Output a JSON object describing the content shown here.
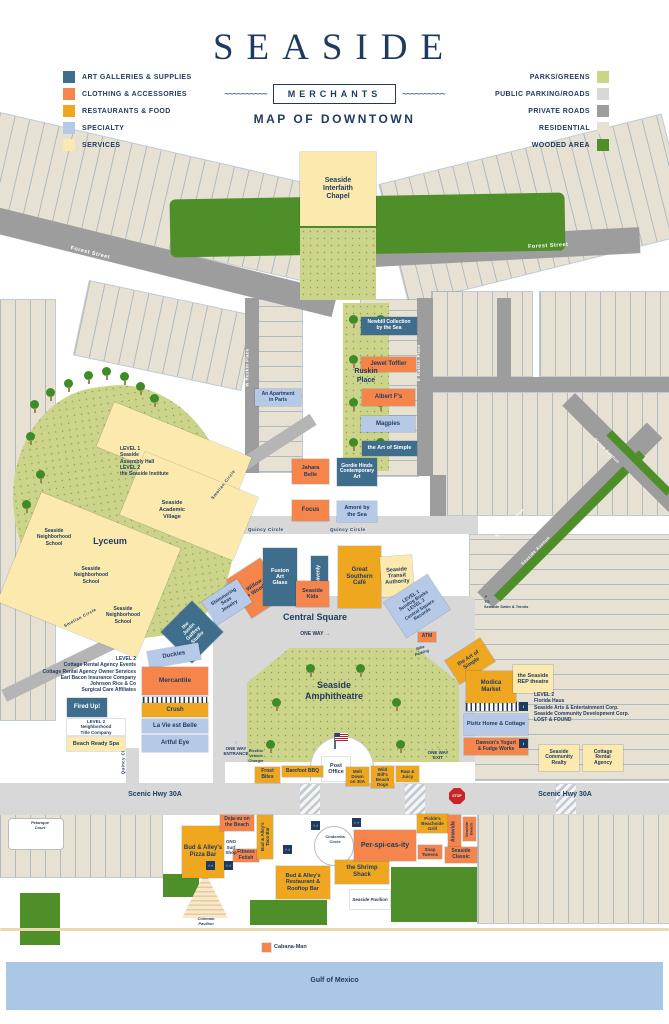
{
  "header": {
    "title": "SEASIDE",
    "badge": "MERCHANTS",
    "subtitle": "MAP OF DOWNTOWN",
    "wave": "~~~~~~~~~~"
  },
  "palette": {
    "navy": "#1e3a5f",
    "art": "#3f6e8c",
    "clothing": "#f5854a",
    "food": "#efa71f",
    "specialty": "#b6c9e7",
    "services": "#fce9ae",
    "parks": "#ccd489",
    "publicRoad": "#d8d8d8",
    "privateRoad": "#9d9d9d",
    "residential": "#e6e1d3",
    "wooded": "#4f8f2a",
    "gulf": "#aac7e6",
    "stop": "#c8242b"
  },
  "legend_left": [
    {
      "label": "ART GALLERIES & SUPPLIES",
      "color": "#3f6e8c"
    },
    {
      "label": "CLOTHING & ACCESSORIES",
      "color": "#f5854a"
    },
    {
      "label": "RESTAURANTS & FOOD",
      "color": "#efa71f"
    },
    {
      "label": "SPECIALTY",
      "color": "#b6c9e7"
    },
    {
      "label": "SERVICES",
      "color": "#fce9ae"
    }
  ],
  "legend_right": [
    {
      "label": "PARKS/GREENS",
      "color": "#ccd489"
    },
    {
      "label": "PUBLIC PARKING/ROADS",
      "color": "#d8d8d8"
    },
    {
      "label": "PRIVATE ROADS",
      "color": "#9d9d9d"
    },
    {
      "label": "RESIDENTIAL",
      "color": "#e6e1d3"
    },
    {
      "label": "WOODED AREA",
      "color": "#4f8f2a"
    }
  ],
  "buildings": [
    {
      "id": "seaside-interfaith-chapel",
      "label": "Seaside\nInterfaith\nChapel",
      "cat": "services",
      "x": 300,
      "y": 152,
      "w": 76,
      "h": 74,
      "fs": 7
    },
    {
      "id": "newbill-collection-by-the-sea",
      "label": "Newbill Collection\nby the Sea",
      "cat": "art",
      "x": 361,
      "y": 317,
      "w": 56,
      "h": 18,
      "fs": 5
    },
    {
      "id": "jewel-toffier",
      "label": "Jewel Toffier",
      "cat": "clothing",
      "x": 361,
      "y": 357,
      "w": 55,
      "h": 15,
      "fs": 6
    },
    {
      "id": "albert-fs",
      "label": "Albert F's",
      "cat": "clothing",
      "x": 362,
      "y": 389,
      "w": 53,
      "h": 17,
      "fs": 6
    },
    {
      "id": "magpies",
      "label": "Magpies",
      "cat": "specialty",
      "x": 361,
      "y": 416,
      "w": 54,
      "h": 16,
      "fs": 6
    },
    {
      "id": "the-art-of-simple-ruskin",
      "label": "the Art of Simple",
      "cat": "art",
      "x": 362,
      "y": 441,
      "w": 55,
      "h": 15,
      "fs": 5.5
    },
    {
      "id": "an-apartment-in-paris",
      "label": "An Apartment\nin Paris",
      "cat": "specialty",
      "x": 255,
      "y": 389,
      "w": 46,
      "h": 17,
      "fs": 5
    },
    {
      "id": "jahara-belle",
      "label": "Jahara\nBelle",
      "cat": "clothing",
      "x": 292,
      "y": 459,
      "w": 37,
      "h": 25,
      "fs": 5.5
    },
    {
      "id": "gordie-hinds-contemporary-art",
      "label": "Gordie Hinds\nContemporary\nArt",
      "cat": "art",
      "x": 337,
      "y": 458,
      "w": 40,
      "h": 28,
      "fs": 5
    },
    {
      "id": "focus",
      "label": "Focus",
      "cat": "clothing",
      "x": 292,
      "y": 500,
      "w": 37,
      "h": 21,
      "fs": 6
    },
    {
      "id": "amore-by-the-sea",
      "label": "Amoré by\nthe Sea",
      "cat": "specialty",
      "x": 337,
      "y": 501,
      "w": 40,
      "h": 21,
      "fs": 5.5
    },
    {
      "id": "willow-woods",
      "label": "Willow\n+ Woods",
      "cat": "clothing",
      "x": 236,
      "y": 565,
      "w": 40,
      "h": 46,
      "fs": 5.5,
      "rot": -33
    },
    {
      "id": "fusion-art-glass",
      "label": "Fusion\nArt\nGlass",
      "cat": "art",
      "x": 263,
      "y": 548,
      "w": 34,
      "h": 58,
      "fs": 5.5
    },
    {
      "id": "heavenly",
      "label": "Heavenly",
      "cat": "art",
      "x": 311,
      "y": 556,
      "w": 17,
      "h": 40,
      "fs": 5,
      "vert": true
    },
    {
      "id": "seaside-kids",
      "label": "Seaside\nKids",
      "cat": "clothing",
      "x": 296,
      "y": 581,
      "w": 33,
      "h": 26,
      "fs": 5.5
    },
    {
      "id": "great-southern-cafe",
      "label": "Great\nSouthern\nCafé",
      "cat": "food",
      "x": 338,
      "y": 546,
      "w": 43,
      "h": 62,
      "fs": 6
    },
    {
      "id": "seaside-transit-authority",
      "label": "Seaside\nTransit\nAuthority",
      "cat": "services",
      "x": 381,
      "y": 556,
      "w": 32,
      "h": 40,
      "fs": 5.5,
      "rot": -4
    },
    {
      "id": "sundog-books-central-square-records",
      "label": "LEVEL 1\nSundog Books\nLEVEL 2\nCentral Square\nRecords",
      "cat": "specialty",
      "x": 391,
      "y": 585,
      "w": 52,
      "h": 42,
      "fs": 4.8,
      "rot": -33
    },
    {
      "id": "shimmering-seas-jewelry",
      "label": "Shimmering\nSeas\nJewelry",
      "cat": "specialty",
      "x": 206,
      "y": 588,
      "w": 42,
      "h": 28,
      "fs": 5,
      "rot": -33
    },
    {
      "id": "the-justin-gaffrey-studio",
      "label": "the\nJustin\nGaffrey\nStudio",
      "cat": "art",
      "x": 170,
      "y": 610,
      "w": 44,
      "h": 44,
      "fs": 5,
      "rot": -45
    },
    {
      "id": "duckies",
      "label": "Duckies",
      "cat": "specialty",
      "x": 148,
      "y": 647,
      "w": 52,
      "h": 17,
      "fs": 6,
      "rot": -10
    },
    {
      "id": "mercantile",
      "label": "Mercantile",
      "cat": "clothing",
      "x": 142,
      "y": 667,
      "w": 66,
      "h": 28,
      "fs": 6.5
    },
    {
      "id": "crush",
      "label": "Crush",
      "cat": "food",
      "x": 142,
      "y": 703,
      "w": 66,
      "h": 14,
      "fs": 6
    },
    {
      "id": "la-vie-est-belle",
      "label": "La Vie est Belle",
      "cat": "specialty",
      "x": 142,
      "y": 719,
      "w": 66,
      "h": 14,
      "fs": 6
    },
    {
      "id": "artful-eye",
      "label": "Artful Eye",
      "cat": "specialty",
      "x": 142,
      "y": 735,
      "w": 66,
      "h": 17,
      "fs": 6
    },
    {
      "id": "fired-up",
      "label": "Fired Up!",
      "cat": "art",
      "x": 67,
      "y": 698,
      "w": 40,
      "h": 19,
      "fs": 6
    },
    {
      "id": "neighborhood-title-company",
      "label": "LEVEL 2\nNeighborhood\nTitle Company",
      "cat": "civic",
      "x": 67,
      "y": 719,
      "w": 58,
      "h": 16,
      "fs": 4.5
    },
    {
      "id": "beach-ready-spa",
      "label": "Beach Ready Spa",
      "cat": "services",
      "x": 67,
      "y": 737,
      "w": 58,
      "h": 14,
      "fs": 5.5
    },
    {
      "id": "the-art-of-simple-square",
      "label": "the Art of\nSimple",
      "cat": "food",
      "x": 449,
      "y": 647,
      "w": 42,
      "h": 28,
      "fs": 5.5,
      "rot": -33
    },
    {
      "id": "modica-market",
      "label": "Modica\nMarket",
      "cat": "food",
      "x": 466,
      "y": 671,
      "w": 50,
      "h": 32,
      "fs": 6
    },
    {
      "id": "the-seaside-rep-theatre",
      "label": "the Seaside\nREP theatre",
      "cat": "services",
      "x": 513,
      "y": 665,
      "w": 40,
      "h": 28,
      "fs": 5.5
    },
    {
      "id": "pizitz-home-and-cottage",
      "label": "Pizitz Home & Cottage",
      "cat": "specialty",
      "x": 464,
      "y": 714,
      "w": 64,
      "h": 21,
      "fs": 5.5
    },
    {
      "id": "dawsons-yogurt-fudge-works",
      "label": "Dawson's Yogurt\n& Fudge Works",
      "cat": "clothing",
      "x": 464,
      "y": 738,
      "w": 64,
      "h": 17,
      "fs": 5
    },
    {
      "id": "seaside-community-realty",
      "label": "Seaside\nCommunity\nRealty",
      "cat": "services",
      "x": 539,
      "y": 745,
      "w": 40,
      "h": 26,
      "fs": 5
    },
    {
      "id": "cottage-rental-agency",
      "label": "Cottage\nRental\nAgency",
      "cat": "services",
      "x": 583,
      "y": 745,
      "w": 40,
      "h": 26,
      "fs": 5
    },
    {
      "id": "post-office",
      "label": "Post\nOffice",
      "cat": "civic",
      "x": 322,
      "y": 757,
      "w": 28,
      "h": 24,
      "fs": 5.5
    },
    {
      "id": "frost-bites",
      "label": "Frost\nBites",
      "cat": "food",
      "x": 255,
      "y": 767,
      "w": 25,
      "h": 16,
      "fs": 5
    },
    {
      "id": "barefoot-bbq",
      "label": "Barefoot BBQ",
      "cat": "food",
      "x": 282,
      "y": 766,
      "w": 41,
      "h": 11,
      "fs": 5
    },
    {
      "id": "melt-down-on-30a",
      "label": "Melt\nDown\non 30A",
      "cat": "food",
      "x": 346,
      "y": 767,
      "w": 23,
      "h": 19,
      "fs": 4.5
    },
    {
      "id": "wild-bills-beach-dogs",
      "label": "Wild\nBill's\nBeach\nDogs",
      "cat": "food",
      "x": 371,
      "y": 766,
      "w": 23,
      "h": 22,
      "fs": 4.5
    },
    {
      "id": "raw-and-juicy",
      "label": "Raw &\nJuicy",
      "cat": "food",
      "x": 396,
      "y": 766,
      "w": 23,
      "h": 16,
      "fs": 4.5
    },
    {
      "id": "atm",
      "label": "ATM",
      "cat": "clothing",
      "x": 418,
      "y": 632,
      "w": 18,
      "h": 10,
      "fs": 5
    },
    {
      "id": "bud-and-alleys-pizza-bar",
      "label": "Bud & Alley's\nPizza Bar",
      "cat": "food",
      "x": 182,
      "y": 826,
      "w": 42,
      "h": 52,
      "fs": 6
    },
    {
      "id": "deja-vu-on-the-beach",
      "label": "Deja-vu on\nthe Beach",
      "cat": "clothing",
      "x": 220,
      "y": 815,
      "w": 34,
      "h": 16,
      "fs": 5
    },
    {
      "id": "fitness-fetish",
      "label": "Fitness\nFetish",
      "cat": "clothing",
      "x": 233,
      "y": 849,
      "w": 26,
      "h": 13,
      "fs": 5
    },
    {
      "id": "bud-and-alleys-taco-bar",
      "label": "Bud & Alley's\nTaco Bar",
      "cat": "food",
      "x": 257,
      "y": 815,
      "w": 16,
      "h": 44,
      "fs": 4.5,
      "vert": true
    },
    {
      "id": "bud-and-alleys-restaurant-rooftop-bar",
      "label": "Bud & Alley's\nRestaurant &\nRooftop Bar",
      "cat": "food",
      "x": 276,
      "y": 866,
      "w": 54,
      "h": 33,
      "fs": 5.5
    },
    {
      "id": "the-shrimp-shack",
      "label": "the Shrimp\nShack",
      "cat": "food",
      "x": 335,
      "y": 860,
      "w": 54,
      "h": 24,
      "fs": 6
    },
    {
      "id": "per-spi-cas-ity",
      "label": "Per-spi-cas-ity",
      "cat": "clothing",
      "x": 354,
      "y": 830,
      "w": 62,
      "h": 31,
      "fs": 7
    },
    {
      "id": "pickles-beachside-grill",
      "label": "Pickle's\nBeachside\nGrill",
      "cat": "food",
      "x": 417,
      "y": 814,
      "w": 31,
      "h": 19,
      "fs": 4.5
    },
    {
      "id": "amavida",
      "label": "Amavida",
      "cat": "clothing",
      "x": 448,
      "y": 815,
      "w": 13,
      "h": 33,
      "fs": 5,
      "vert": true
    },
    {
      "id": "seaside-beach",
      "label": "Seaside\nBeach",
      "cat": "clothing",
      "x": 463,
      "y": 817,
      "w": 13,
      "h": 24,
      "fs": 4,
      "vert": true
    },
    {
      "id": "snap-tweens",
      "label": "Snap\nTweens",
      "cat": "clothing",
      "x": 418,
      "y": 845,
      "w": 24,
      "h": 14,
      "fs": 4.5
    },
    {
      "id": "seaside-classic",
      "label": "Seaside\nClassic",
      "cat": "clothing",
      "x": 445,
      "y": 847,
      "w": 32,
      "h": 16,
      "fs": 5
    },
    {
      "id": "seaside-pavilion",
      "label": "Seaside Pavilion",
      "cat": "civic",
      "x": 350,
      "y": 890,
      "w": 40,
      "h": 19,
      "fs": 4.5,
      "italic": true
    },
    {
      "id": "cabana-man-marker",
      "label": "",
      "cat": "clothing",
      "x": 262,
      "y": 943,
      "w": 9,
      "h": 9,
      "fs": 4
    }
  ],
  "text_blocks": [
    {
      "id": "assembly-hall-institute",
      "x": 120,
      "y": 446,
      "w": 72,
      "fs": 5,
      "align": "left",
      "lines": [
        "LEVEL 1",
        "Seaside",
        "Assembly Hall",
        "LEVEL 2",
        "the Seaside Institute"
      ]
    },
    {
      "id": "seaside-academic-village",
      "x": 144,
      "y": 500,
      "w": 56,
      "fs": 5.5,
      "lines": [
        "Seaside",
        "Academic",
        "Village"
      ]
    },
    {
      "id": "seaside-neighborhood-school-1",
      "x": 33,
      "y": 528,
      "w": 42,
      "fs": 5,
      "lines": [
        "Seaside",
        "Neighborhood",
        "School"
      ]
    },
    {
      "id": "seaside-neighborhood-school-2",
      "x": 70,
      "y": 566,
      "w": 42,
      "fs": 5,
      "lines": [
        "Seaside",
        "Neighborhood",
        "School"
      ]
    },
    {
      "id": "seaside-neighborhood-school-3",
      "x": 100,
      "y": 606,
      "w": 46,
      "fs": 5,
      "lines": [
        "Seaside",
        "Neighborhood",
        "School"
      ]
    },
    {
      "id": "lyceum-label",
      "x": 80,
      "y": 536,
      "w": 60,
      "fs": 9,
      "lines": [
        "Lyceum"
      ]
    },
    {
      "id": "ruskin-place-label",
      "x": 341,
      "y": 368,
      "w": 50,
      "fs": 7,
      "lines": [
        "Ruskin",
        "Place"
      ]
    },
    {
      "id": "central-square-label",
      "x": 268,
      "y": 612,
      "w": 94,
      "fs": 9,
      "lines": [
        "Central Square"
      ]
    },
    {
      "id": "one-way-center",
      "x": 282,
      "y": 631,
      "w": 66,
      "fs": 5,
      "lines": [
        "ONE WAY  →"
      ]
    },
    {
      "id": "amphitheatre-label",
      "x": 288,
      "y": 680,
      "w": 92,
      "fs": 9,
      "lines": [
        "Seaside",
        "Amphitheatre"
      ]
    },
    {
      "id": "cottage-rental-agency-events",
      "x": 28,
      "y": 656,
      "w": 108,
      "fs": 5,
      "align": "right",
      "lines": [
        "LEVEL 2",
        "Cottage Rental Agency Events",
        "Cottage Rental Agency Owner Services",
        "Earl Bacon Insurance Company",
        "Johnson Rice & Co",
        "Surgical Care Affiliates"
      ]
    },
    {
      "id": "florida-haus-lost-and-found",
      "x": 534,
      "y": 692,
      "w": 106,
      "fs": 5,
      "align": "left",
      "lines": [
        "LEVEL 2",
        "Florida Haus",
        "Seaside Arts & Entertainment Corp.",
        "Seaside Community Development Corp.",
        "LOST & FOUND"
      ]
    },
    {
      "id": "to-seaside-swim-tennis",
      "x": 484,
      "y": 594,
      "w": 72,
      "fs": 4,
      "align": "left",
      "lines": [
        "↗",
        "TO",
        "Seaside Swim & Tennis"
      ]
    },
    {
      "id": "electric-vehicle-charger",
      "x": 240,
      "y": 748,
      "w": 32,
      "fs": 4,
      "lines": [
        "Electric",
        "Vehicle",
        "Charger"
      ]
    },
    {
      "id": "bike-parking",
      "x": 406,
      "y": 645,
      "w": 30,
      "fs": 4,
      "italic": true,
      "rot": -18,
      "lines": [
        "Bike",
        "Parking"
      ]
    },
    {
      "id": "entrance-one-way",
      "x": 214,
      "y": 740,
      "w": 44,
      "fs": 4.5,
      "lines": [
        "↑",
        "ONE WAY",
        "ENTRANCE"
      ]
    },
    {
      "id": "exit-one-way",
      "x": 418,
      "y": 744,
      "w": 40,
      "fs": 4.5,
      "lines": [
        "↓",
        "ONE WAY",
        "EXIT"
      ]
    },
    {
      "id": "scenic-hwy-30a-west",
      "x": 90,
      "y": 791,
      "w": 130,
      "fs": 7,
      "lines": [
        "Scenic Hwy 30A"
      ]
    },
    {
      "id": "scenic-hwy-30a-east",
      "x": 500,
      "y": 791,
      "w": 130,
      "fs": 7,
      "lines": [
        "Scenic Hwy 30A"
      ]
    },
    {
      "id": "ono-surf-shop",
      "x": 219,
      "y": 839,
      "w": 24,
      "fs": 4.5,
      "lines": [
        "ONO",
        "Surf",
        "Shop"
      ]
    },
    {
      "id": "cinderella-circle",
      "x": 317,
      "y": 834,
      "w": 36,
      "fs": 4,
      "lines": [
        "Cinderella",
        "Circle"
      ]
    },
    {
      "id": "petanque-court",
      "x": 16,
      "y": 820,
      "w": 48,
      "fs": 4,
      "italic": true,
      "lines": [
        "Petanque",
        "Court"
      ]
    },
    {
      "id": "coleman-pavilion",
      "x": 185,
      "y": 916,
      "w": 42,
      "fs": 4,
      "italic": true,
      "lines": [
        "Coleman",
        "Pavilion"
      ]
    },
    {
      "id": "cabana-man",
      "x": 274,
      "y": 944,
      "w": 52,
      "fs": 5.5,
      "align": "left",
      "lines": [
        "Cabana-Man"
      ]
    },
    {
      "id": "gulf-of-mexico",
      "x": 0,
      "y": 977,
      "w": 669,
      "fs": 7,
      "lines": [
        "Gulf of Mexico"
      ]
    }
  ],
  "street_labels": [
    {
      "id": "forest-street-west",
      "label": "Forest Street",
      "x": 70,
      "y": 250,
      "fs": 5.5,
      "rot": 14,
      "light": true
    },
    {
      "id": "forest-street-east",
      "label": "Forest Street",
      "x": 528,
      "y": 243,
      "fs": 5.5,
      "rot": -3,
      "light": true
    },
    {
      "id": "w-ruskin-place",
      "label": "W Ruskin Place",
      "x": 228,
      "y": 365,
      "fs": 4.2,
      "rot": -90,
      "light": true
    },
    {
      "id": "e-ruskin-place",
      "label": "E Ruskin Place",
      "x": 400,
      "y": 360,
      "fs": 4.2,
      "rot": -90,
      "light": true
    },
    {
      "id": "quincy-circle-west",
      "label": "Quincy Circle",
      "x": 248,
      "y": 527,
      "fs": 4.5
    },
    {
      "id": "quincy-circle-east",
      "label": "Quincy Circle",
      "x": 330,
      "y": 527,
      "fs": 4.5
    },
    {
      "id": "quincy-circle-south",
      "label": "Quincy Circle",
      "x": 106,
      "y": 755,
      "fs": 4.2,
      "rot": -90
    },
    {
      "id": "smolian-circle-north",
      "label": "Smolian Circle",
      "x": 205,
      "y": 482,
      "fs": 4.2,
      "rot": -52
    },
    {
      "id": "smolian-circle-south",
      "label": "Smolian Circle",
      "x": 62,
      "y": 615,
      "fs": 4.2,
      "rot": -28
    },
    {
      "id": "seaside-avenue-1",
      "label": "Seaside Avenue",
      "x": 490,
      "y": 520,
      "fs": 4.2,
      "rot": -45,
      "light": true
    },
    {
      "id": "seaside-avenue-2",
      "label": "Seaside Avenue",
      "x": 516,
      "y": 548,
      "fs": 4.2,
      "rot": -45,
      "light": true
    },
    {
      "id": "grove-avenue",
      "label": "Grove Avenue",
      "x": 590,
      "y": 448,
      "fs": 4.2,
      "rot": 45,
      "light": true
    }
  ],
  "icons": [
    {
      "id": "info-icon",
      "x": 519,
      "y": 702,
      "g": "i"
    },
    {
      "id": "info-icon",
      "x": 519,
      "y": 739,
      "g": "i"
    },
    {
      "id": "restroom-icon",
      "x": 206,
      "y": 861,
      "g": "♀♂"
    },
    {
      "id": "restroom-icon",
      "x": 224,
      "y": 861,
      "g": "♀♂"
    },
    {
      "id": "restroom-icon",
      "x": 283,
      "y": 845,
      "g": "♀♂"
    },
    {
      "id": "restroom-icon",
      "x": 311,
      "y": 821,
      "g": "♀♂"
    },
    {
      "id": "restroom-icon",
      "x": 352,
      "y": 818,
      "g": "♀♂"
    },
    {
      "id": "stop-sign",
      "x": 449,
      "y": 788,
      "g": "STOP",
      "stop": true
    }
  ]
}
